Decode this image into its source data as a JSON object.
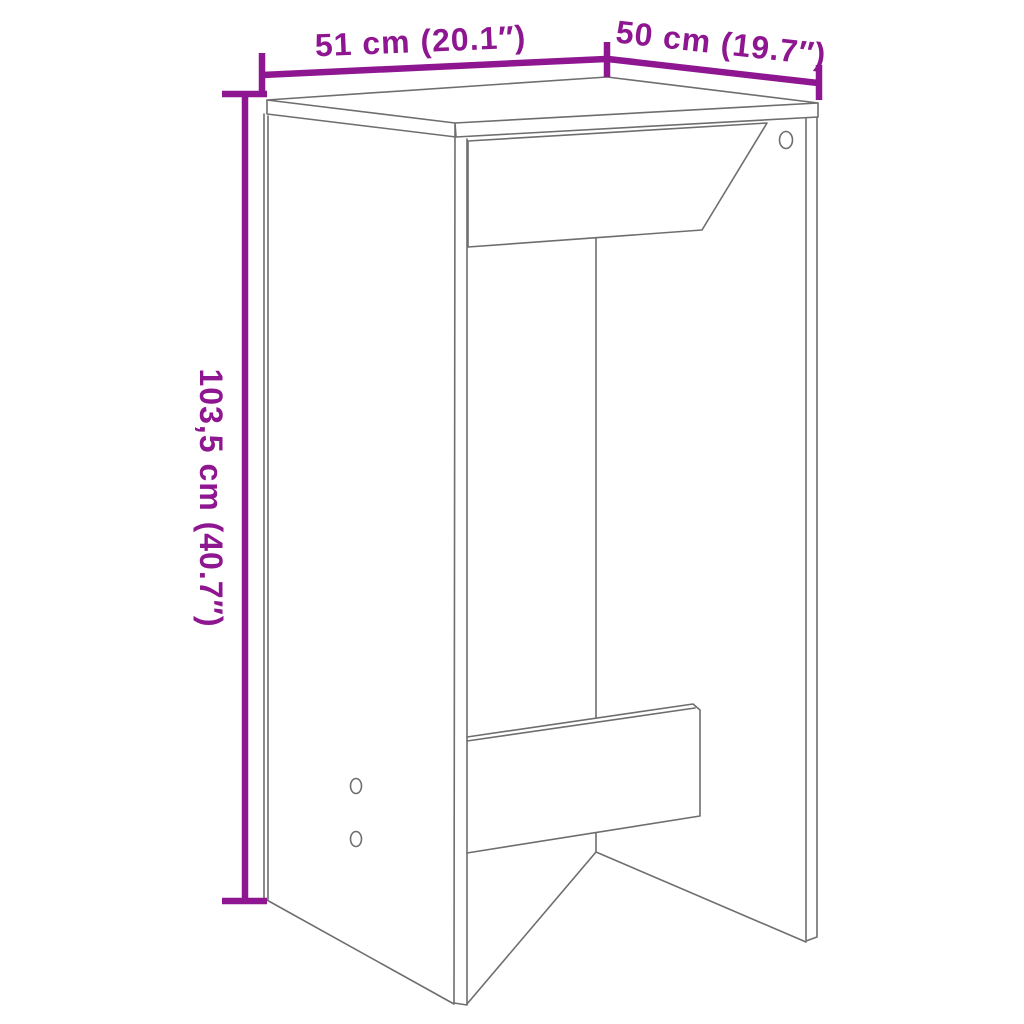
{
  "diagram": {
    "type": "furniture-dimension-diagram",
    "product": "bar-table",
    "labels": {
      "width": "51 cm (20.1″)",
      "depth": "50 cm (19.7″)",
      "height": "103,5 cm (40.7″)"
    },
    "colors": {
      "dimension_accent": "#8E1690",
      "drawing_outline": "#6E6E6E",
      "background": "#FFFFFF"
    }
  }
}
